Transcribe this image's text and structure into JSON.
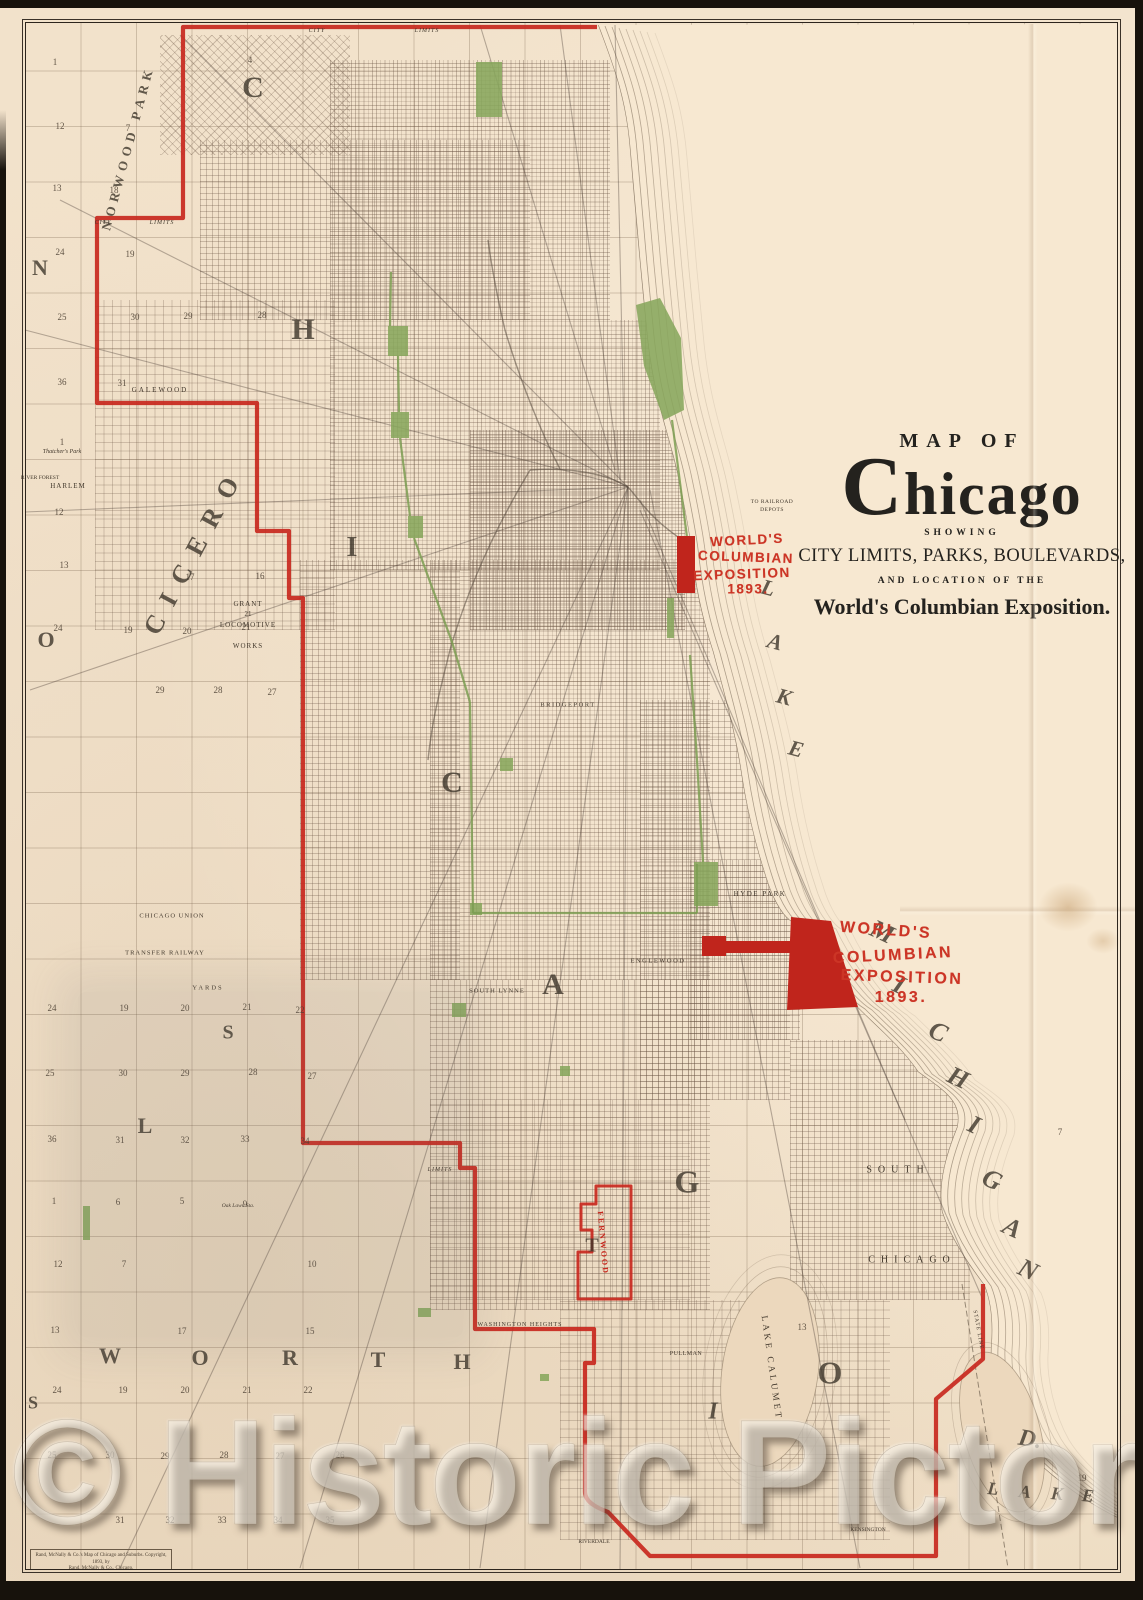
{
  "title_block": {
    "line1": "MAP OF",
    "name": "Chicago",
    "line2": "SHOWING",
    "line3": "CITY LIMITS, PARKS, BOULEVARDS,",
    "line4": "AND LOCATION OF THE",
    "line5": "World's Columbian Exposition."
  },
  "expo_label_1": {
    "l1": "WORLD'S",
    "l2": "COLUMBIAN",
    "l3": "EXPOSITION",
    "l4": "1893."
  },
  "expo_label_2": {
    "l1": "WORLD'S",
    "l2": "COLUMBIAN",
    "l3": "EXPOSITION",
    "l4": "1893."
  },
  "watermark": "© Historic Pictoric",
  "imprint": {
    "line1": "Rand, McNally & Co.'s Map of Chicago and Suburbs. Copyright, 1893, by",
    "line2": "Rand, McNally & Co., Chicago."
  },
  "colors": {
    "boundary_red": "#c8281e",
    "expo_red": "#cc3526",
    "park_green": "#87a65c",
    "paper": "#f2e2cb",
    "ink": "#3e362b"
  },
  "giant_letters": [
    [
      "C",
      253,
      88,
      30,
      0,
      0
    ],
    [
      "H",
      303,
      330,
      30,
      0,
      0
    ],
    [
      "I",
      352,
      548,
      28,
      0,
      0
    ],
    [
      "C",
      452,
      783,
      30,
      0,
      0
    ],
    [
      "A",
      553,
      985,
      30,
      0,
      0
    ],
    [
      "G",
      687,
      1182,
      32,
      0,
      0
    ],
    [
      "O",
      830,
      1373,
      32,
      0,
      0
    ],
    [
      "N",
      40,
      268,
      22,
      0,
      0
    ],
    [
      "O",
      46,
      640,
      22,
      0,
      0
    ],
    [
      "S",
      228,
      1033,
      20,
      0,
      0
    ],
    [
      "L",
      145,
      1126,
      22,
      0,
      0
    ],
    [
      "W",
      110,
      1356,
      22,
      0,
      0
    ],
    [
      "O",
      200,
      1358,
      22,
      0,
      0
    ],
    [
      "R",
      290,
      1358,
      22,
      0,
      0
    ],
    [
      "T",
      378,
      1360,
      22,
      0,
      0
    ],
    [
      "H",
      462,
      1362,
      22,
      0,
      0
    ],
    [
      "S",
      33,
      1403,
      18,
      0,
      0
    ],
    [
      "T",
      592,
      1246,
      20,
      0,
      0
    ],
    [
      "I",
      713,
      1412,
      24,
      0,
      1
    ],
    [
      "M",
      882,
      932,
      26,
      25,
      1
    ],
    [
      "I",
      899,
      985,
      26,
      25,
      1
    ],
    [
      "C",
      938,
      1032,
      26,
      25,
      1
    ],
    [
      "H",
      958,
      1078,
      26,
      25,
      1
    ],
    [
      "I",
      974,
      1125,
      26,
      25,
      1
    ],
    [
      "G",
      992,
      1180,
      26,
      25,
      1
    ],
    [
      "A",
      1012,
      1228,
      26,
      25,
      1
    ],
    [
      "N",
      1028,
      1270,
      26,
      25,
      1
    ],
    [
      "L",
      768,
      588,
      22,
      15,
      1
    ],
    [
      "A",
      775,
      642,
      22,
      15,
      1
    ],
    [
      "K",
      784,
      697,
      22,
      15,
      1
    ],
    [
      "E",
      796,
      749,
      22,
      15,
      1
    ],
    [
      "L",
      993,
      1489,
      18,
      5,
      1
    ],
    [
      "A",
      1025,
      1492,
      18,
      5,
      1
    ],
    [
      "K",
      1057,
      1494,
      18,
      5,
      1
    ],
    [
      "E",
      1088,
      1496,
      18,
      5,
      1
    ],
    [
      "D.",
      1030,
      1440,
      24,
      10,
      1
    ]
  ],
  "township_labels": [
    {
      "t": "NORWOOD PARK",
      "x": 128,
      "y": 148,
      "s": 13,
      "ls": 5,
      "r": -75
    },
    {
      "t": "CICERO",
      "x": 195,
      "y": 550,
      "s": 26,
      "ls": 14,
      "r": -62
    }
  ],
  "place_labels": [
    {
      "t": "GALEWOOD",
      "x": 160,
      "y": 390,
      "s": 7,
      "ls": 2
    },
    {
      "t": "HARLEM",
      "x": 68,
      "y": 486,
      "s": 7,
      "ls": 1
    },
    {
      "t": "RIVER FOREST",
      "x": 40,
      "y": 478,
      "s": 5.5,
      "ls": 0
    },
    {
      "t": "Thatcher's Park",
      "x": 62,
      "y": 452,
      "s": 6,
      "ls": 0,
      "it": 1
    },
    {
      "t": "BRIDGEPORT",
      "x": 568,
      "y": 705,
      "s": 6.5,
      "ls": 1.5
    },
    {
      "t": "SOUTH LYNNE",
      "x": 497,
      "y": 991,
      "s": 6.5,
      "ls": 1
    },
    {
      "t": "ENGLEWOOD",
      "x": 658,
      "y": 961,
      "s": 6.5,
      "ls": 1.5
    },
    {
      "t": "HYDE PARK",
      "x": 760,
      "y": 894,
      "s": 7,
      "ls": 1.5
    },
    {
      "t": "SOUTH",
      "x": 898,
      "y": 1170,
      "s": 10,
      "ls": 6
    },
    {
      "t": "CHICAGO",
      "x": 912,
      "y": 1260,
      "s": 10,
      "ls": 6
    },
    {
      "t": "WASHINGTON HEIGHTS",
      "x": 520,
      "y": 1325,
      "s": 6,
      "ls": 1
    },
    {
      "t": "PULLMAN",
      "x": 686,
      "y": 1354,
      "s": 6,
      "ls": 0.5
    },
    {
      "t": "RIVERDALE",
      "x": 594,
      "y": 1542,
      "s": 5.5,
      "ls": 0
    },
    {
      "t": "KENSINGTON",
      "x": 868,
      "y": 1530,
      "s": 5.5,
      "ls": 0
    },
    {
      "t": "CHICAGO UNION",
      "x": 172,
      "y": 916,
      "s": 6.5,
      "ls": 1
    },
    {
      "t": "TRANSFER RAILWAY",
      "x": 165,
      "y": 953,
      "s": 6.5,
      "ls": 1
    },
    {
      "t": "YARDS",
      "x": 208,
      "y": 988,
      "s": 6.5,
      "ls": 2
    },
    {
      "t": "TO RAILROAD",
      "x": 772,
      "y": 502,
      "s": 5.5,
      "ls": 0.5
    },
    {
      "t": "DEPOTS",
      "x": 772,
      "y": 510,
      "s": 5.5,
      "ls": 0.5
    },
    {
      "t": "CITY",
      "x": 317,
      "y": 31,
      "s": 6,
      "ls": 1,
      "it": 1
    },
    {
      "t": "LIMITS",
      "x": 427,
      "y": 31,
      "s": 6,
      "ls": 1,
      "it": 1
    },
    {
      "t": "CITY",
      "x": 103,
      "y": 223,
      "s": 6,
      "ls": 1,
      "it": 1
    },
    {
      "t": "LIMITS",
      "x": 162,
      "y": 223,
      "s": 6,
      "ls": 1,
      "it": 1
    },
    {
      "t": "LIMITS",
      "x": 440,
      "y": 1170,
      "s": 6,
      "ls": 1,
      "it": 1
    },
    {
      "t": "FERNWOOD",
      "x": 603,
      "y": 1243,
      "s": 8,
      "ls": 2,
      "r": 85,
      "c": "#c8281e"
    },
    {
      "t": "LAKE CALUMET",
      "x": 772,
      "y": 1368,
      "s": 9,
      "ls": 3,
      "r": 82
    },
    {
      "t": "STATE LINE",
      "x": 978,
      "y": 1330,
      "s": 5.5,
      "ls": 1,
      "r": 80
    },
    {
      "t": "Oak Lawn Sta.",
      "x": 238,
      "y": 1206,
      "s": 5.5,
      "ls": 0,
      "it": 1
    },
    {
      "t": "GRANT",
      "x": 248,
      "y": 604,
      "s": 7,
      "ls": 1
    },
    {
      "t": "21",
      "x": 248,
      "y": 614,
      "s": 7,
      "ls": 0
    },
    {
      "t": "LOCOMOTIVE",
      "x": 248,
      "y": 625,
      "s": 7,
      "ls": 1
    },
    {
      "t": "WORKS",
      "x": 248,
      "y": 646,
      "s": 7,
      "ls": 1
    }
  ],
  "section_numbers": [
    [
      "1",
      55,
      62
    ],
    [
      "4",
      250,
      60
    ],
    [
      "12",
      60,
      126
    ],
    [
      "7",
      128,
      128
    ],
    [
      "13",
      57,
      188
    ],
    [
      "18",
      114,
      190
    ],
    [
      "24",
      60,
      252
    ],
    [
      "19",
      130,
      254
    ],
    [
      "25",
      62,
      317
    ],
    [
      "30",
      135,
      317
    ],
    [
      "29",
      188,
      316
    ],
    [
      "28",
      262,
      315
    ],
    [
      "36",
      62,
      382
    ],
    [
      "31",
      122,
      383
    ],
    [
      "1",
      62,
      442
    ],
    [
      "12",
      59,
      512
    ],
    [
      "13",
      64,
      565
    ],
    [
      "17",
      190,
      577
    ],
    [
      "16",
      260,
      576
    ],
    [
      "24",
      58,
      628
    ],
    [
      "19",
      128,
      630
    ],
    [
      "20",
      187,
      631
    ],
    [
      "21",
      246,
      627
    ],
    [
      "29",
      160,
      690
    ],
    [
      "28",
      218,
      690
    ],
    [
      "27",
      272,
      692
    ],
    [
      "24",
      52,
      1008
    ],
    [
      "19",
      124,
      1008
    ],
    [
      "20",
      185,
      1008
    ],
    [
      "21",
      247,
      1007
    ],
    [
      "22",
      300,
      1010
    ],
    [
      "25",
      50,
      1073
    ],
    [
      "30",
      123,
      1073
    ],
    [
      "29",
      185,
      1073
    ],
    [
      "28",
      253,
      1072
    ],
    [
      "27",
      312,
      1076
    ],
    [
      "36",
      52,
      1139
    ],
    [
      "31",
      120,
      1140
    ],
    [
      "32",
      185,
      1140
    ],
    [
      "33",
      245,
      1139
    ],
    [
      "34",
      305,
      1141
    ],
    [
      "1",
      54,
      1201
    ],
    [
      "6",
      118,
      1202
    ],
    [
      "5",
      182,
      1201
    ],
    [
      "9",
      245,
      1204
    ],
    [
      "12",
      58,
      1264
    ],
    [
      "7",
      124,
      1264
    ],
    [
      "10",
      312,
      1264
    ],
    [
      "13",
      55,
      1330
    ],
    [
      "17",
      182,
      1331
    ],
    [
      "15",
      310,
      1331
    ],
    [
      "24",
      57,
      1390
    ],
    [
      "19",
      123,
      1390
    ],
    [
      "20",
      185,
      1390
    ],
    [
      "21",
      247,
      1390
    ],
    [
      "22",
      308,
      1390
    ],
    [
      "25",
      52,
      1455
    ],
    [
      "30",
      110,
      1455
    ],
    [
      "29",
      165,
      1456
    ],
    [
      "28",
      224,
      1455
    ],
    [
      "27",
      280,
      1456
    ],
    [
      "26",
      340,
      1455
    ],
    [
      "31",
      120,
      1520
    ],
    [
      "32",
      170,
      1520
    ],
    [
      "33",
      222,
      1520
    ],
    [
      "34",
      278,
      1520
    ],
    [
      "35",
      330,
      1520
    ],
    [
      "13",
      802,
      1327
    ],
    [
      "7",
      1060,
      1132
    ],
    [
      "19",
      1082,
      1478
    ]
  ]
}
